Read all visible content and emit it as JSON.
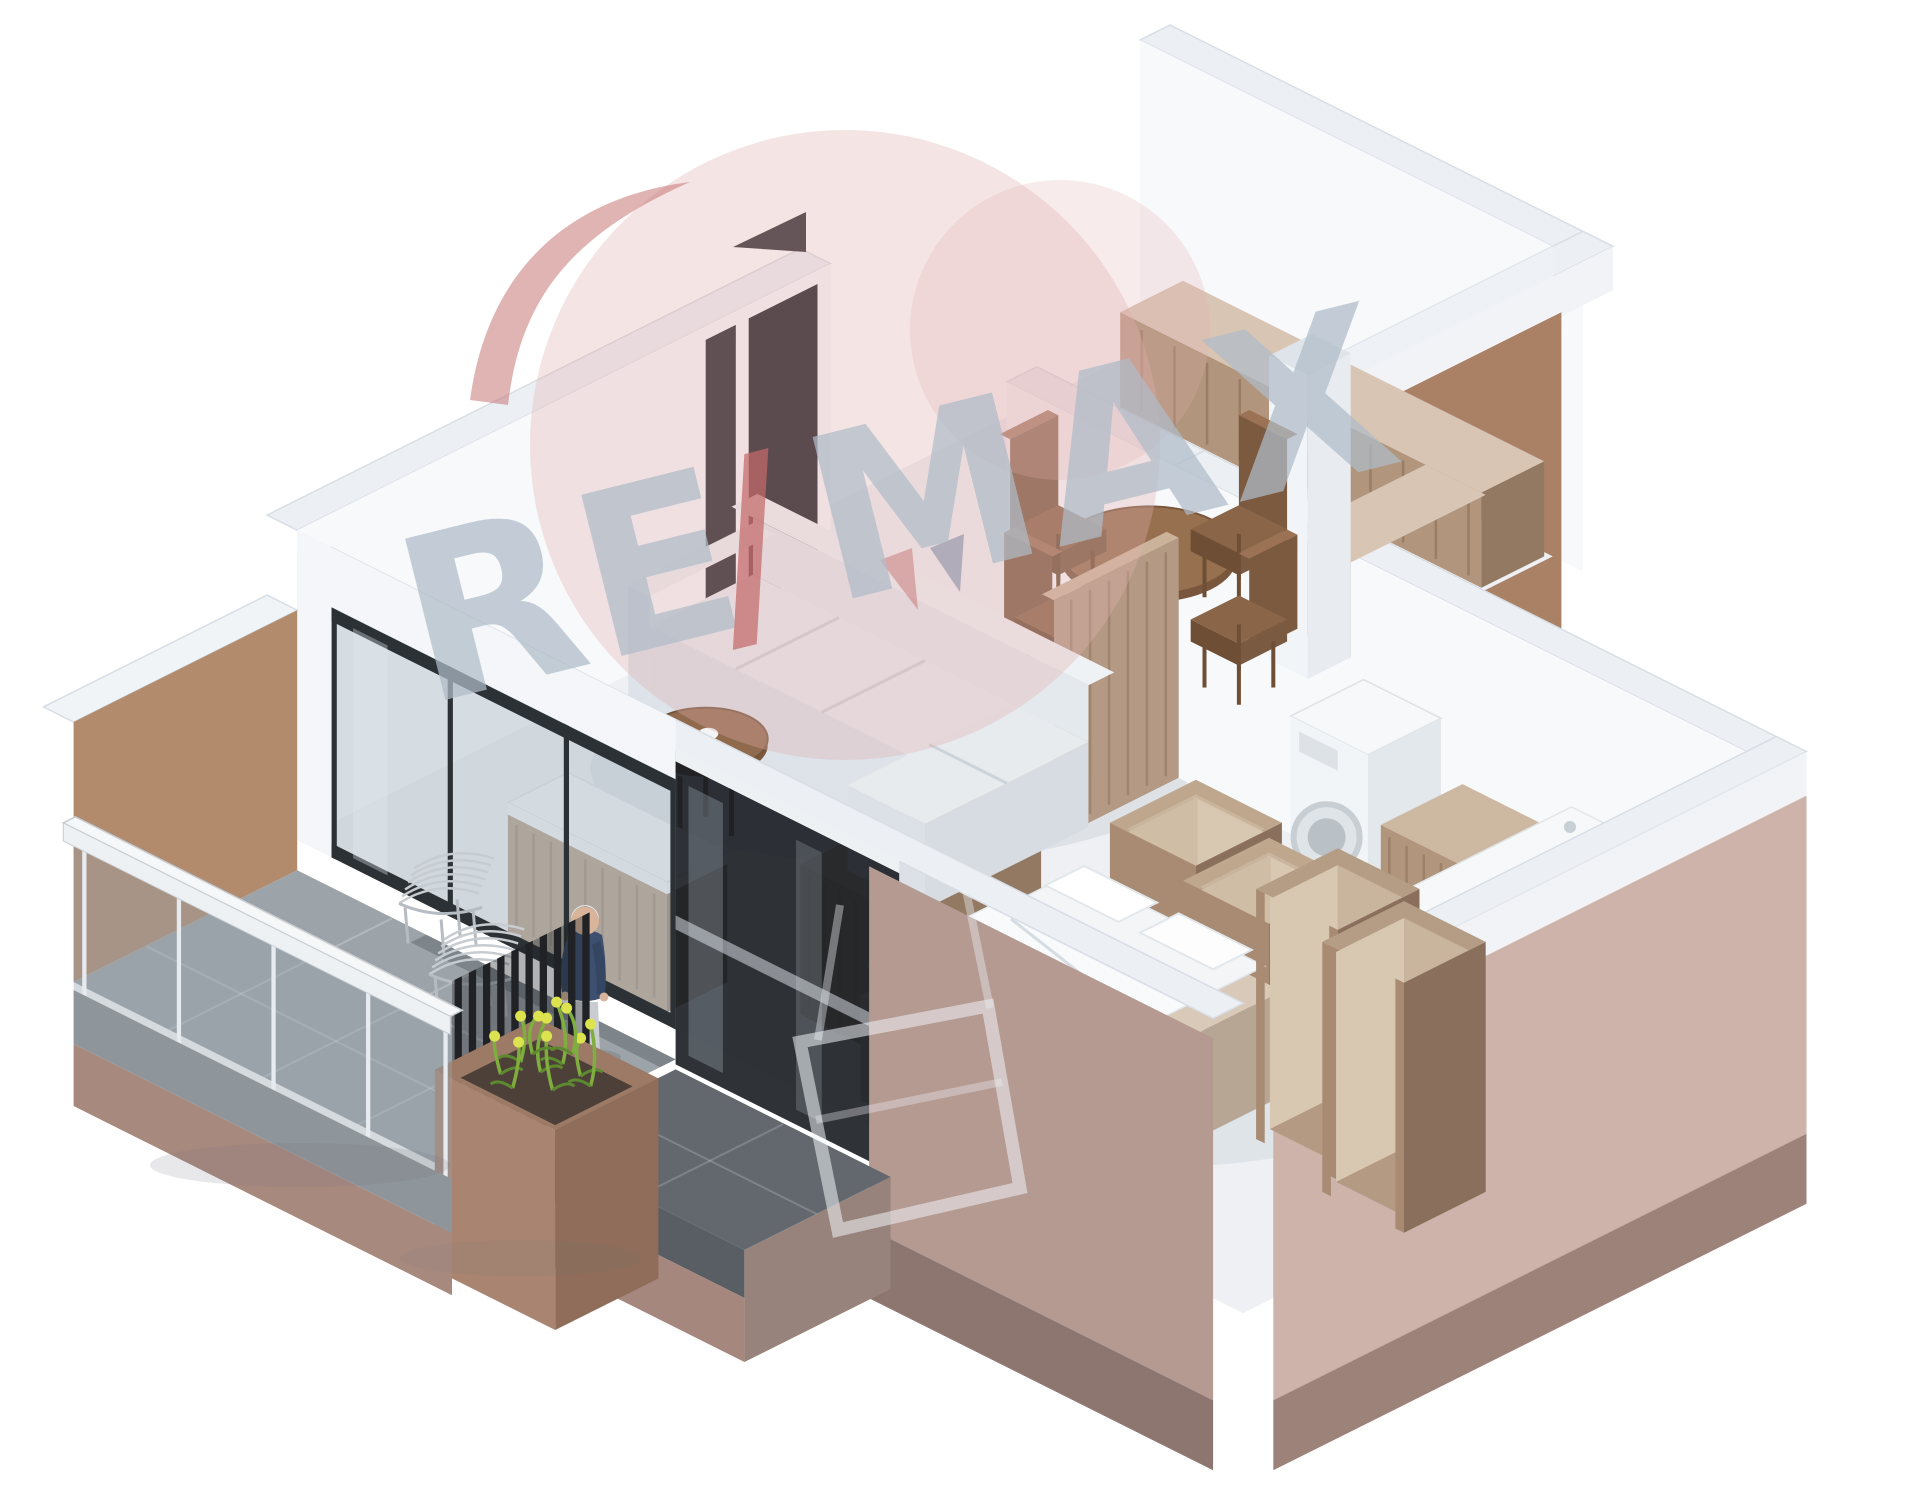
{
  "page": {
    "title": "Isometric 3D floor-plan rendering of a one-bedroom apartment with balcony"
  },
  "watermark": {
    "left": "RE",
    "slash": "/",
    "right": "MAX",
    "brand": "RE/MAX",
    "symbol": "remax-hot-air-balloon"
  },
  "colors": {
    "wallTop": "#ecf0f4",
    "wallEdge": "#d8dee6",
    "wallFace": "#f7f9fb",
    "wallShade": "#eef1f5",
    "extBrown": "#ab8166",
    "extBrownDark": "#6b5242",
    "tanWall": "#b28b6d",
    "mauve": "#b59a92",
    "mauvePlinth": "#8d7570",
    "rightExt": "#cdb3aa",
    "rightPlinth": "#9c8278",
    "floor": "#eef0f3",
    "bathFloor": "#f0f2f5",
    "balconyFloor": "#9da4a9",
    "terrace": "#62686e",
    "wood": "#b1957c",
    "woodTop": "#d8c5b3",
    "woodSide": "#937862",
    "woodDark": "#8a6f5c",
    "woodInner": "#c9b59e",
    "tableWood": "#96704f",
    "tableDark": "#7a573c",
    "chairWood": "#8a6548",
    "chairDark": "#6e4f36",
    "sofa": "#e9edf0",
    "sofaFront": "#dde3e8",
    "sofaBack": "#eff2f5",
    "appliance": "#f6f8fa",
    "opening": "#17181c",
    "slat": "#202226",
    "glass": "rgba(150,163,173,0.40)",
    "doorGlass": "rgba(170,185,195,0.45)",
    "darkGlazing": "rgba(24,28,33,0.90)",
    "personSweater": "#3d5070",
    "personSweaterDark": "#354663",
    "personPants": "#d3d6da",
    "personHair": "#e9e6e1",
    "personSkin": "#d9b49a",
    "plantGreen": "#7fae3e",
    "plantDark": "#5d8a2f",
    "flowerYellow": "#dde24f",
    "wmPink": "#e3b0b0",
    "wmRed": "#c46a6a",
    "wmNavy": "#5a6788",
    "wmGray": "#b0bcc8",
    "wmLight": "#eef2f6",
    "arrow": "#26272b"
  },
  "scene_elements": [
    "kitchen-counter",
    "oven",
    "tall-kitchen-column",
    "dining-table",
    "dining-chairs",
    "washing-machine",
    "bathroom-vanity",
    "storage-cubes",
    "bathtub",
    "bed",
    "bedroom-dresser",
    "wardrobe-boxes",
    "sofa",
    "coffee-table",
    "tv-cabinet",
    "balcony",
    "outdoor-wire-chairs",
    "person-figure",
    "planter-flowers",
    "slat-screen",
    "glass-railing",
    "balcony-door",
    "entry-doorway",
    "north-arrow"
  ]
}
